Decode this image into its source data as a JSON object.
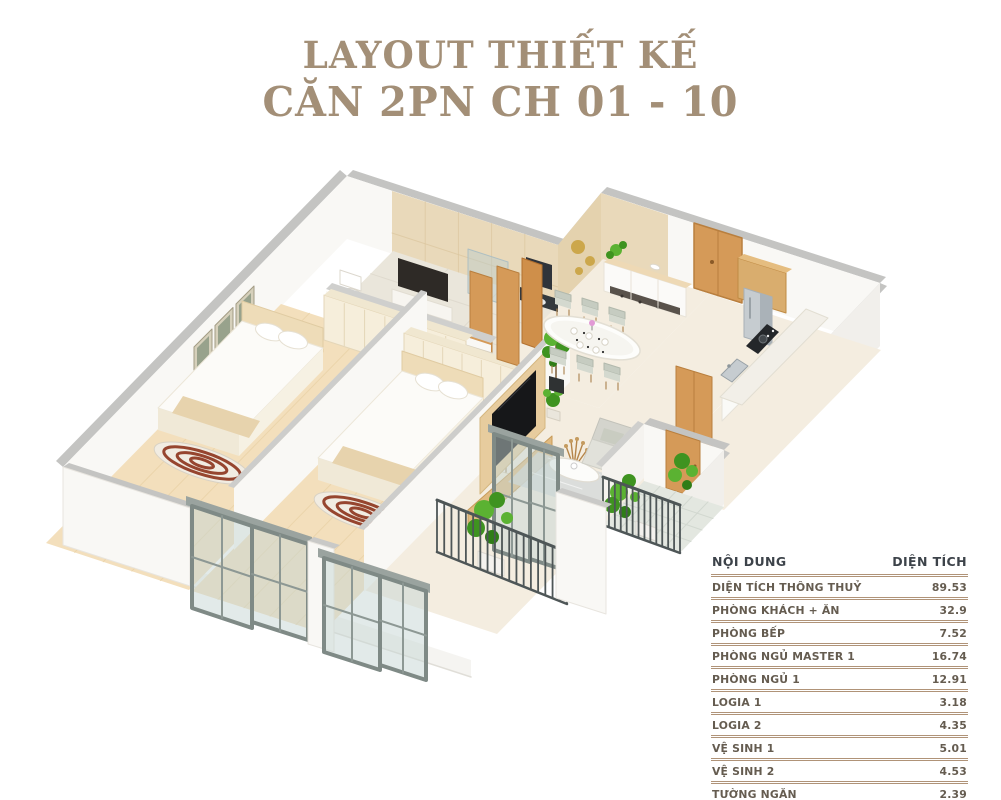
{
  "title": {
    "line1": "LAYOUT THIẾT KẾ",
    "line2": "CĂN 2PN CH 01 - 10"
  },
  "area_table": {
    "headers": {
      "name": "NỘI DUNG",
      "area": "DIỆN TÍCH"
    },
    "rows": [
      {
        "name": "DIỆN TÍCH THÔNG THUỶ",
        "area": "89.53"
      },
      {
        "name": "PHÒNG KHÁCH + ĂN",
        "area": "32.9"
      },
      {
        "name": "PHÒNG BẾP",
        "area": "7.52"
      },
      {
        "name": "PHÒNG NGỦ MASTER 1",
        "area": "16.74"
      },
      {
        "name": "PHÒNG NGỦ 1",
        "area": "12.91"
      },
      {
        "name": "LOGIA 1",
        "area": "3.18"
      },
      {
        "name": "LOGIA 2",
        "area": "4.35"
      },
      {
        "name": "VỆ SINH 1",
        "area": "5.01"
      },
      {
        "name": "VỆ SINH 2",
        "area": "4.53"
      },
      {
        "name": "TƯỜNG NGĂN",
        "area": "2.39"
      }
    ]
  },
  "colors": {
    "titleText": "#a38f77",
    "tableHeaderText": "#3d434a",
    "tableRowText": "#655c50",
    "tableRule": "#b09378",
    "capGray": "#c4c4c2",
    "capGrayL": "#cfcfcd",
    "wallWhite": "#f9f8f5",
    "wallShade": "#f1efeb",
    "tile": "#e9d9ba",
    "tileDark": "#e4d2ae",
    "tileLine": "#dbc69e",
    "floorWood": "#f3dfbc",
    "plank": "#e8d0a4",
    "floorCream": "#f4ede0",
    "floorBath": "#eae6db",
    "floorTile": "#e3e7e0",
    "gridLine": "#d2d8d0",
    "wood": "#d59a58",
    "woodDark": "#b97f3e",
    "cream": "#f6eedb",
    "creamLine": "#e4d6b8",
    "white": "#ffffff",
    "steel": "#c6ccd0",
    "steelDark": "#aab2b8",
    "dark": "#2e2a26",
    "tv": "#161719",
    "sofa": "#e1e1da",
    "sofaDark": "#d4d4cd",
    "chair": "#d4d9cf",
    "chairBack": "#c6ccc1",
    "rug": "#d3d8da",
    "rail": "#4e5657",
    "frame": "#7f8a86",
    "frameLight": "#8d9894",
    "glass": "rgba(198,214,212,0.5)",
    "plant1": "#5bb232",
    "plant2": "#3f9320",
    "plant3": "#2f7d17",
    "gold": "#c9a240",
    "slab": "#f5f4f1",
    "slabEdge": "#e0ded8",
    "stripe": "#96452f",
    "topBar": "#9aa39f"
  }
}
